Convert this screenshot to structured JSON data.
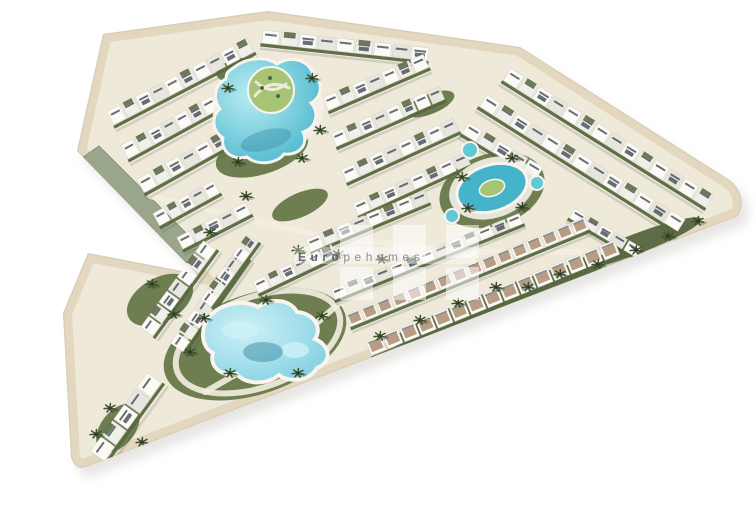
{
  "scene": {
    "title": "aerial-3d-render-residential-resort-complex",
    "description": "Bird's-eye architectural render of a V-shaped white apartment complex with three turquoise pools, lawns and palm trees on a white background",
    "background": "#ffffff",
    "width": 756,
    "height": 528
  },
  "watermark": {
    "bold": "Euro",
    "rest": "pehomes",
    "text_color": "#4f4f4f",
    "rest_color": "#7c7c7c",
    "block_color": "#ffffff",
    "block_opacity": 0.52,
    "blocks": {
      "cols": [
        340,
        393,
        446
      ],
      "rows": [
        225,
        267
      ],
      "w": 33,
      "h": 33
    },
    "glow": {
      "x": 294,
      "y": 247,
      "w": 182,
      "h": 17,
      "opacity": 0.38
    },
    "text_x": 298,
    "text_y": 261,
    "font_size": 12,
    "letter_spacing": 4.5
  },
  "palette": {
    "bg": "#ffffff",
    "shadow": "#cfcdc8",
    "base": "#efe9da",
    "rim": "#e3d7c0",
    "edge": "#d8cdb6",
    "embank": "#9aa68c",
    "embank_dark": "#87947a",
    "lawn": "#66784a",
    "lawn_dark": "#55663d",
    "hedge": "#57693f",
    "palm": "#3d5130",
    "palm_core": "#2b3a22",
    "bldg_a": "#fbfaf7",
    "bldg_b": "#f0efe9",
    "bldg_c": "#e7e6df",
    "bldg_line": "#d0cec6",
    "win": "#474c52",
    "solar": "#4d565e",
    "roofgreen": "#5d6d45",
    "tan": "#b79d85",
    "tan_base": "#fcfaf6",
    "path": "#f3eee0",
    "deck": "#f4f1e8",
    "pool_deep": "#45b4ca",
    "pool_mid": "#62c8d8",
    "pool_light": "#b9ecf3",
    "pool3": "#7fcfe1",
    "pool3_light": "#cdf1f7",
    "pool_rim": "#f7f5ee",
    "pool_shadow": "#2f7f98",
    "island": "#a6c376",
    "island_path": "#ecead9"
  },
  "site": {
    "outline": "M103,34 L268,11 L520,47 L731,181 Q748,197 738,216 L341,369 L86,467 Q75,471 71,457 L63,313 L88,253 L197,274 L77,151 Z",
    "embankment": "82,158 193,269 208,255 99,146",
    "shadow_offset": {
      "dx": 7,
      "dy": 9,
      "opacity": 0.5
    }
  },
  "greens": [
    [
      262,
      152,
      48,
      22,
      -18,
      "lawn"
    ],
    [
      242,
      70,
      26,
      12,
      -10,
      "lawn"
    ],
    [
      492,
      190,
      54,
      36,
      -18,
      "lawn"
    ],
    [
      255,
      344,
      95,
      50,
      -19,
      "lawn"
    ],
    [
      160,
      300,
      36,
      22,
      -30,
      "lawn"
    ],
    [
      118,
      428,
      28,
      17,
      -52,
      "lawn"
    ],
    [
      498,
      302,
      118,
      13,
      -21,
      "lawn_dark"
    ],
    [
      636,
      244,
      70,
      10,
      -21,
      "lawn_dark"
    ],
    [
      430,
      104,
      26,
      10,
      -22,
      "lawn"
    ],
    [
      300,
      205,
      30,
      12,
      -24,
      "lawn"
    ]
  ],
  "roads": {
    "polylines": [
      {
        "pts": [
          150,
          196,
          320,
          236,
          470,
          252,
          610,
          252
        ],
        "w": 6
      },
      {
        "pts": [
          205,
          392,
          300,
          338,
          345,
          298
        ],
        "w": 6
      }
    ],
    "loop": {
      "cx": 258,
      "cy": 342,
      "rx": 86,
      "ry": 45,
      "rot": -20,
      "w": 6
    }
  },
  "rows": [
    [
      106,
      112,
      248,
      38,
      15,
      16,
      "white"
    ],
    [
      120,
      146,
      226,
      88,
      15,
      15,
      "white"
    ],
    [
      136,
      180,
      222,
      132,
      15,
      15,
      "white"
    ],
    [
      152,
      214,
      214,
      180,
      14,
      14,
      "white"
    ],
    [
      176,
      238,
      246,
      202,
      13,
      14,
      "white"
    ],
    [
      262,
      30,
      430,
      48,
      13,
      17,
      "white"
    ],
    [
      322,
      98,
      424,
      54,
      14,
      15,
      "white"
    ],
    [
      330,
      134,
      440,
      86,
      14,
      15,
      "white"
    ],
    [
      340,
      170,
      454,
      118,
      14,
      15,
      "white"
    ],
    [
      352,
      204,
      466,
      152,
      13,
      15,
      "white"
    ],
    [
      305,
      240,
      425,
      190,
      13,
      15,
      "white"
    ],
    [
      510,
      68,
      714,
      196,
      14,
      17,
      "white"
    ],
    [
      486,
      94,
      686,
      220,
      14,
      17,
      "white"
    ],
    [
      468,
      122,
      544,
      168,
      13,
      15,
      "white"
    ],
    [
      574,
      208,
      642,
      248,
      11,
      14,
      "white"
    ],
    [
      140,
      328,
      204,
      240,
      15,
      14,
      "white"
    ],
    [
      170,
      344,
      236,
      250,
      15,
      14,
      "white"
    ],
    [
      200,
      300,
      248,
      234,
      13,
      13,
      "white"
    ],
    [
      90,
      452,
      148,
      372,
      17,
      17,
      "white"
    ],
    [
      252,
      282,
      332,
      244,
      13,
      14,
      "white"
    ],
    [
      365,
      342,
      615,
      240,
      15,
      17,
      "tan"
    ],
    [
      345,
      315,
      585,
      217,
      13,
      16,
      "tan"
    ],
    [
      330,
      290,
      520,
      213,
      11,
      15,
      "white"
    ]
  ],
  "pools": {
    "p1": {
      "deck": {
        "cx": 268,
        "cy": 112,
        "rx": 56,
        "ry": 44,
        "rot": -15
      },
      "path": "M233,68 C247,57 266,56 277,64 C291,55 309,60 313,74 C324,82 322,97 311,103 C320,113 316,128 303,132 C309,144 299,156 284,154 C277,164 257,166 247,157 C233,161 220,151 223,138 C212,131 211,116 220,109 C212,98 215,84 226,79 C226,72 229,71 233,68 Z",
      "island": {
        "cx": 271,
        "cy": 90,
        "r": 23
      },
      "island_curves": [
        "M255,96 q14,-18 34,-8",
        "M256,82 q16,14 30,2"
      ],
      "shadow": {
        "cx": 266,
        "cy": 140,
        "rx": 26,
        "ry": 10,
        "rot": -15
      }
    },
    "p2": {
      "deck": {
        "cx": 492,
        "cy": 188,
        "rx": 44,
        "ry": 30,
        "rot": -18
      },
      "pool": {
        "cx": 492,
        "cy": 188,
        "rx": 36,
        "ry": 23,
        "rot": -18
      },
      "island": {
        "cx": 492,
        "cy": 188,
        "rx": 13,
        "ry": 8,
        "rot": -18
      },
      "satellites": [
        [
          470,
          150,
          8
        ],
        [
          537,
          183,
          7
        ],
        [
          452,
          216,
          7
        ]
      ]
    },
    "p3": {
      "path": "M209,317 C221,303 243,299 258,307 C272,297 291,300 297,312 C313,313 323,327 315,339 C331,346 332,362 317,368 C310,381 289,383 279,375 C267,385 245,385 237,374 C221,377 209,366 213,353 C201,347 200,329 209,317 Z",
      "patches": [
        [
          240,
          330,
          18,
          9
        ],
        [
          295,
          350,
          14,
          8
        ]
      ],
      "shadow": {
        "cx": 263,
        "cy": 352,
        "rx": 20,
        "ry": 10
      }
    }
  },
  "palms": [
    [
      298,
      250
    ],
    [
      338,
      254
    ],
    [
      382,
      259
    ],
    [
      528,
      287
    ],
    [
      560,
      274
    ],
    [
      598,
      264
    ],
    [
      636,
      250
    ],
    [
      668,
      236
    ],
    [
      698,
      221
    ],
    [
      462,
      177
    ],
    [
      512,
      158
    ],
    [
      522,
      207
    ],
    [
      468,
      208
    ],
    [
      228,
      88
    ],
    [
      312,
      78
    ],
    [
      320,
      130
    ],
    [
      238,
      162
    ],
    [
      302,
      158
    ],
    [
      204,
      318
    ],
    [
      230,
      373
    ],
    [
      298,
      373
    ],
    [
      322,
      316
    ],
    [
      266,
      300
    ],
    [
      190,
      352
    ],
    [
      110,
      408
    ],
    [
      142,
      442
    ],
    [
      96,
      434
    ],
    [
      152,
      284
    ],
    [
      174,
      314
    ],
    [
      380,
      336
    ],
    [
      420,
      320
    ],
    [
      458,
      303
    ],
    [
      496,
      287
    ],
    [
      246,
      196
    ],
    [
      210,
      232
    ]
  ]
}
